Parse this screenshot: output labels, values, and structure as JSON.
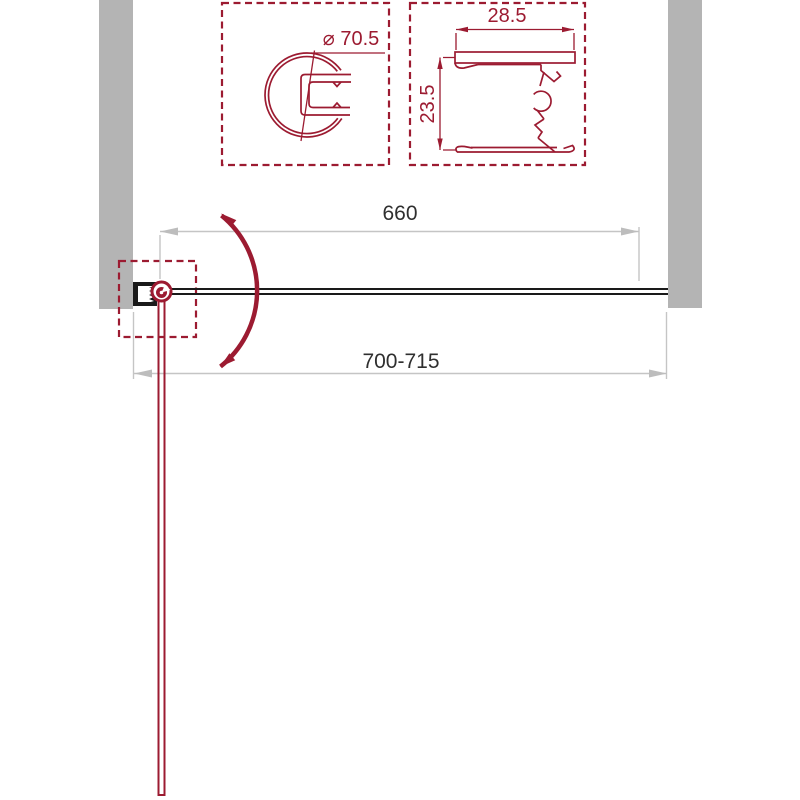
{
  "colors": {
    "accent": "#9C1B31",
    "wall-gray": "#B4B4B4",
    "dim-gray": "#C5C5C5",
    "dim-arrow-gray": "#BDBDBD",
    "dim-text": "#2F2F2F",
    "ink-black": "#1A1A1A",
    "background": "#FFFFFF"
  },
  "detail_views": {
    "knob_profile": {
      "diameter_label": "⌀ 70.5"
    },
    "wall_profile": {
      "width_label": "28.5",
      "depth_label": "23.5"
    }
  },
  "plan_view": {
    "glass_width_label": "660",
    "opening_width_label": "700-715"
  }
}
